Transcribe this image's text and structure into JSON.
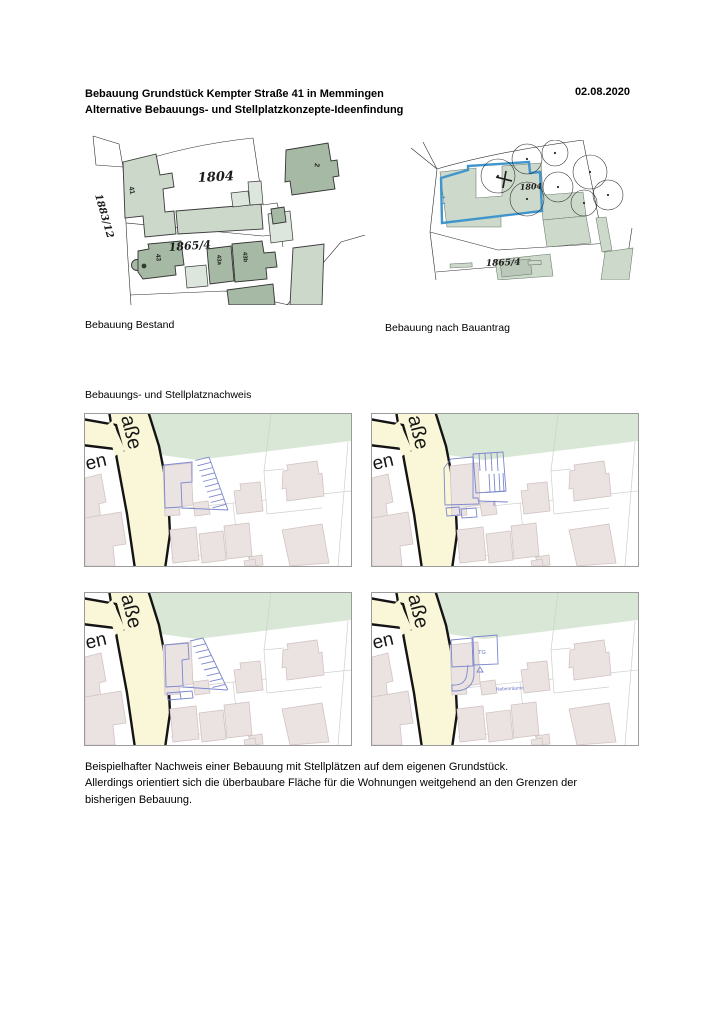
{
  "header": {
    "title": "Bebauung Grundstück Kempter Straße 41 in Memmingen",
    "subtitle": "Alternative Bebauungs- und Stellplatzkonzepte-Ideenfindung",
    "date": "02.08.2020"
  },
  "captions": {
    "bestand": "Bebauung Bestand",
    "bauantrag": "Bebauung nach Bauantrag"
  },
  "section": {
    "label": "Bebauungs- und Stellplatznachweis"
  },
  "paragraph": {
    "line1": "Beispielhafter Nachweis einer Bebauung mit Stellplätzen auf dem eigenen Grundstück.",
    "line2": "Allerdings orientiert sich die überbaubare Fläche für die Wohnungen weitgehend an den Grenzen der",
    "line3": "bisherigen Bebauung."
  },
  "map_bestand": {
    "labels": {
      "parcel_1804": "1804",
      "parcel_1865": "1865/4",
      "parcel_1883": "1883/12",
      "house_41": "41",
      "house_43": "43",
      "house_43a": "43a",
      "house_43b": "43b",
      "house_2": "2"
    }
  },
  "map_bauantrag": {
    "labels": {
      "parcel_1804": "1804",
      "parcel_1865": "1865/4"
    }
  },
  "basemap": {
    "labels": {
      "street": "aße",
      "street2": "en"
    }
  },
  "map_tg": {
    "labels": {
      "tg": "TG",
      "nebenraeume": "Nebenräume"
    }
  },
  "colors": {
    "building_light_sage": "#cbd8ca",
    "building_dark_sage": "#a5b9a4",
    "plan_blue": "#3f95cc",
    "overlay_blue": "#7c87cd",
    "street_yellow": "#faf6d8",
    "green_area": "#d9e7d6",
    "webmap_building": "#eae3e1"
  }
}
